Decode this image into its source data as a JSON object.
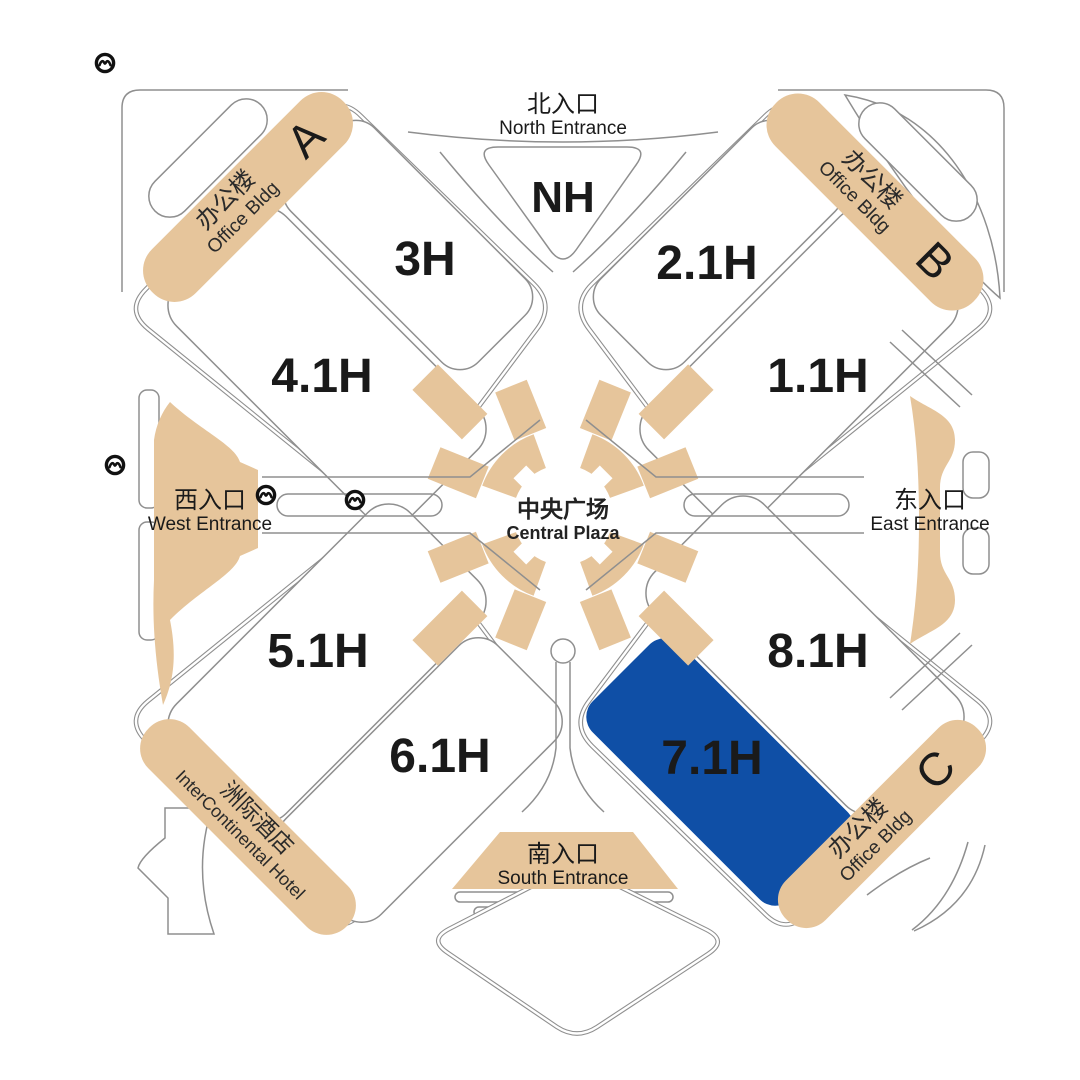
{
  "map": {
    "halls": {
      "nh": {
        "label": "NH",
        "state": "normal"
      },
      "h3": {
        "label": "3H",
        "state": "normal"
      },
      "h21": {
        "label": "2.1H",
        "state": "dimmed"
      },
      "h41": {
        "label": "4.1H",
        "state": "normal"
      },
      "h11": {
        "label": "1.1H",
        "state": "dimmed"
      },
      "h51": {
        "label": "5.1H",
        "state": "normal"
      },
      "h61": {
        "label": "6.1H",
        "state": "normal"
      },
      "h71": {
        "label": "7.1H",
        "state": "highlighted"
      },
      "h81": {
        "label": "8.1H",
        "state": "normal"
      }
    },
    "entrances": {
      "north": {
        "zh": "北入口",
        "en": "North Entrance"
      },
      "west": {
        "zh": "西入口",
        "en": "West Entrance"
      },
      "east": {
        "zh": "东入口",
        "en": "East Entrance"
      },
      "south": {
        "zh": "南入口",
        "en": "South Entrance"
      }
    },
    "plaza": {
      "zh": "中央广场",
      "en": "Central Plaza"
    },
    "buildings": {
      "a": {
        "zh": "办公楼",
        "en": "Office Bldg",
        "letter": "A"
      },
      "b": {
        "zh": "办公楼",
        "en": "Office Bldg",
        "letter": "B"
      },
      "c": {
        "zh": "办公楼",
        "en": "Office Bldg",
        "letter": "C"
      },
      "hotel": {
        "zh": "洲际酒店",
        "en": "InterContinental Hotel"
      }
    },
    "icons": {
      "metro": "shanghai-metro-logo"
    },
    "colors": {
      "tan": "#e6c59b",
      "blue": "#0f4fa6",
      "outline": "#8f8f8f",
      "label_black": "#1a1a1a",
      "label_dimmed": "#a9a9a9",
      "label_highlight": "#ffffff"
    }
  }
}
